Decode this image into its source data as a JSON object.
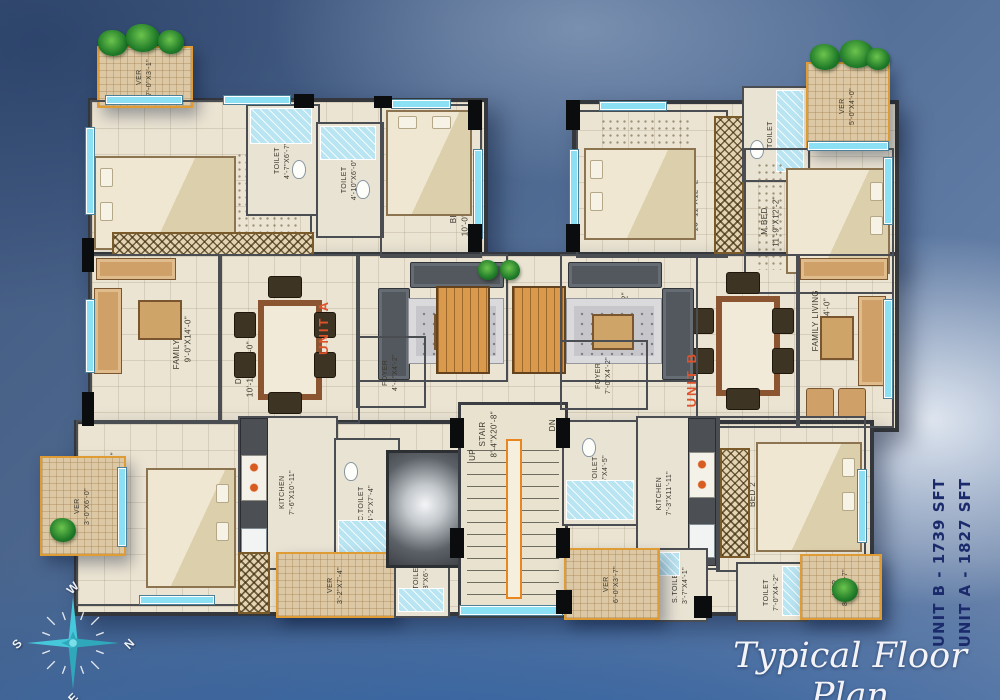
{
  "title": "Typical Floor Plan",
  "side_labels": {
    "unit_a_area": "UNIT A - 1827 SFT",
    "unit_b_area": "UNIT B - 1739 SFT"
  },
  "unit_markers": {
    "a": "UNIT A",
    "b": "UNIT B"
  },
  "compass": {
    "n": "N",
    "e": "E",
    "s": "S",
    "w": "W"
  },
  "stair": {
    "name": "STAIR",
    "dims": "8'-4\"X20'-8\"",
    "up": "UP",
    "dn": "DN"
  },
  "rooms": {
    "a_ver_top": {
      "name": "VER",
      "dims": "7'-0\"X3'-1\""
    },
    "a_mbed": {
      "name": "M.BED",
      "dims": "12'-0\"X14'-0\""
    },
    "a_toilet1": {
      "name": "TOILET",
      "dims": "4'-7\"X6'-7\""
    },
    "a_toilet2": {
      "name": "TOILET",
      "dims": "4'-10\"X6'-0\""
    },
    "a_bed1": {
      "name": "BED 1",
      "dims": "10'-0\"X14'-0\""
    },
    "a_family_living": {
      "name": "FAMILY LIVING",
      "dims": "9'-0\"X14'-0\""
    },
    "a_dining": {
      "name": "DINING",
      "dims": "10'-10\"X14'-0\""
    },
    "a_living": {
      "name": "LIVING",
      "dims": "10'-0\"X14'-2\""
    },
    "a_foyer": {
      "name": "FOYER",
      "dims": "4'-4\"X4'-2\""
    },
    "a_bed2": {
      "name": "BED 2",
      "dims": "13'-0\"X14'-7\""
    },
    "a_ver_left": {
      "name": "VER",
      "dims": "3'-0\"X6'-0\""
    },
    "a_kitchen": {
      "name": "KITCHEN",
      "dims": "7'-6\"X10'-11\""
    },
    "a_ctoilet": {
      "name": "C.TOILET",
      "dims": "4'-2\"X7'-4\""
    },
    "a_ver_bottom": {
      "name": "VER",
      "dims": "3'-2\"X7'-4\""
    },
    "a_stoilet": {
      "name": "S.TOILET",
      "dims": "3'-8\"X6'-0\""
    },
    "b_bed1": {
      "name": "BED 1",
      "dims": "13'-11\"X12'-2\""
    },
    "b_toilet_top": {
      "name": "TOILET",
      "dims": "6'-6\"X4'-5\""
    },
    "b_ver_top": {
      "name": "VER",
      "dims": "5'-0\"X4'-0\""
    },
    "b_mbed": {
      "name": "M.BED",
      "dims": "11'-9\"X12'-2\""
    },
    "b_family_living": {
      "name": "FAMILY LIVING",
      "dims": "6'-4\"X14'-0\""
    },
    "b_dining": {
      "name": "DINING",
      "dims": "10'-0\"X14'-5\""
    },
    "b_living": {
      "name": "LIVING",
      "dims": "10'-0\"X14'-2\""
    },
    "b_foyer": {
      "name": "FOYER",
      "dims": "7'-0\"X4'-2\""
    },
    "b_ctoilet": {
      "name": "C.TOILET",
      "dims": "8'-6\"X4'-5\""
    },
    "b_kitchen": {
      "name": "KITCHEN",
      "dims": "7'-3\"X11'-11\""
    },
    "b_bed2": {
      "name": "BED 2",
      "dims": "15'-1\"X11'-11\""
    },
    "b_toilet_bottom": {
      "name": "TOILET",
      "dims": "7'-0\"X4'-2\""
    },
    "b_stoilet": {
      "name": "S.TOILET",
      "dims": "3'-7\"X4'-1\""
    },
    "b_ver_bottom": {
      "name": "VER",
      "dims": "6'-0\"X3'-7\""
    },
    "b_ver_bottom_right": {
      "name": "VER",
      "dims": "8'-1\"X4'-7\""
    }
  },
  "colors": {
    "accent_orange": "#e0532a",
    "navy_text": "#1b2a6b",
    "veranda_border": "#df9c35",
    "window_cyan": "#8ce0f4",
    "wall": "#4a4d51",
    "floor": "#ebe4d3"
  }
}
